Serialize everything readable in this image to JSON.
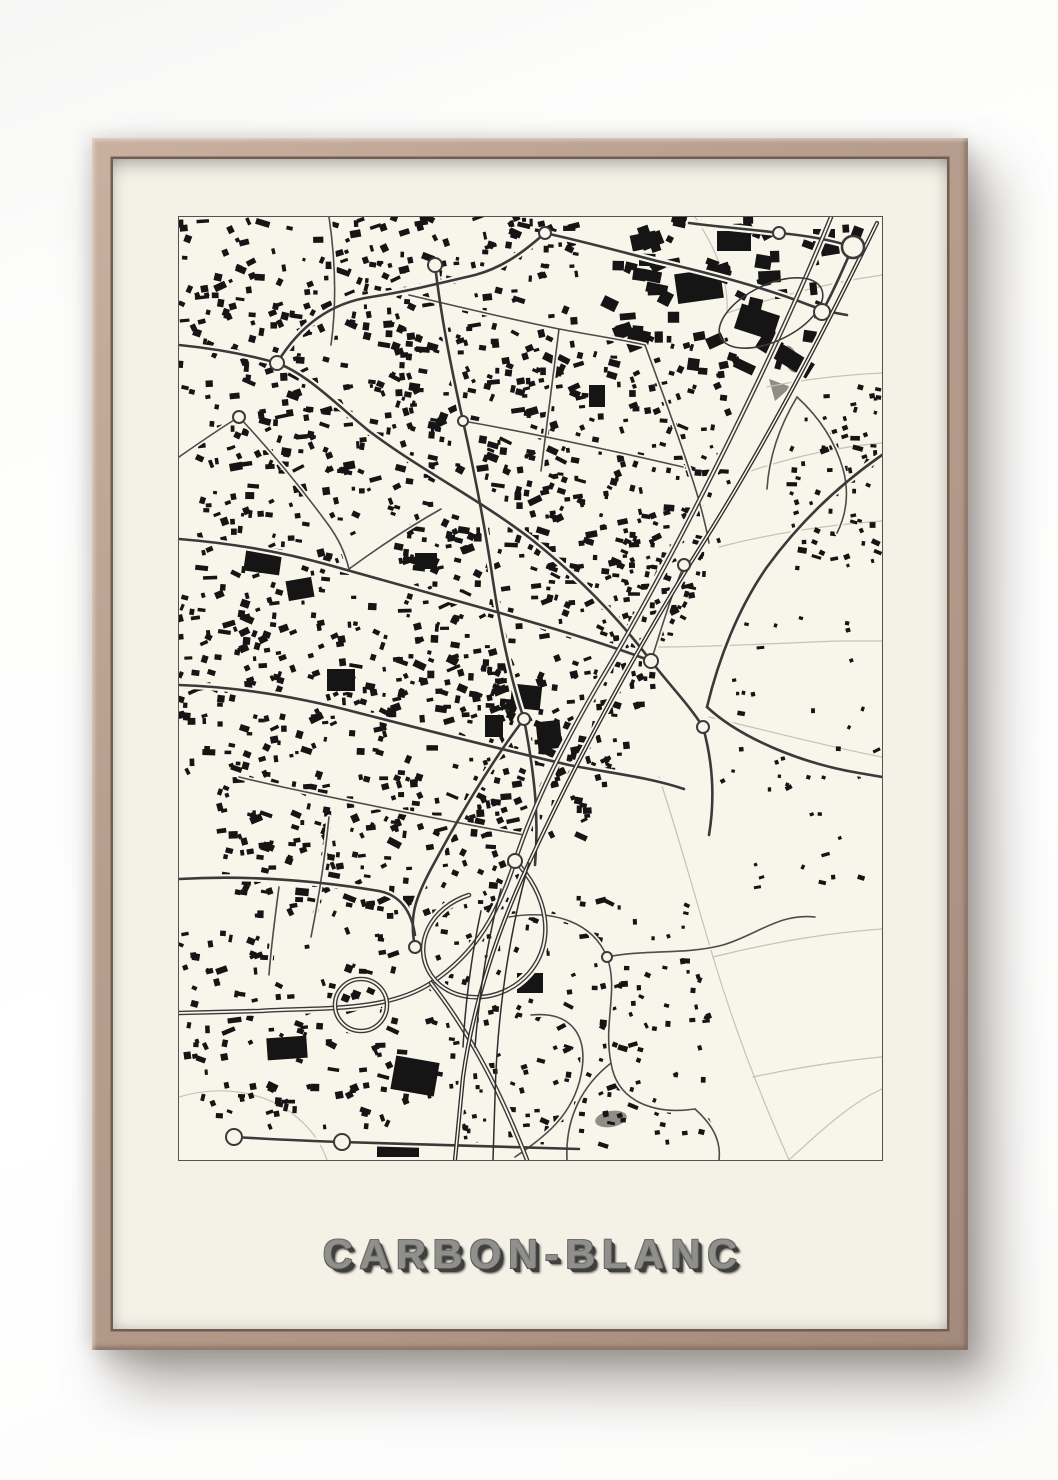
{
  "poster": {
    "title": "CARBON-BLANC"
  },
  "map": {
    "viewbox": "0 0 703 943",
    "seed": 7,
    "colors": {
      "paper": "#f8f5ea",
      "ink": "#151515",
      "road": "#3a3a3a",
      "road_minor": "#4c4c4c",
      "field": "#c6c3b5",
      "gray_fill": "#8e8e86"
    },
    "rail_line": [
      700,
      0.45
    ],
    "field_lines": [
      "M516,0 C536,30 550,62 548,96",
      "M548,96 C590,82 634,70 678,62 L703,58",
      "M588,170 C626,162 664,158 703,156",
      "M566,256 C612,240 658,230 703,226",
      "M540,330 C594,316 648,308 703,304",
      "M476,430 C540,430 600,426 660,424 L703,424",
      "M530,500 C590,514 650,530 703,540",
      "M480,560 C500,620 516,680 534,740 C552,800 574,860 600,920 L610,943",
      "M534,740 C590,726 646,716 703,712",
      "M574,860 C630,848 680,842 703,840",
      "M610,943 C650,906 676,884 703,872",
      "M0,880 C40,868 80,874 110,894 C132,910 142,926 148,943"
    ],
    "roads_minor": [
      "M150,0 C156,40 158,84 152,128",
      "M230,78 C280,90 330,102 380,112 C412,118 440,122 466,128",
      "M380,112 C374,160 368,208 362,254",
      "M466,128 C482,172 498,214 512,258 C520,282 526,304 530,326",
      "M284,204 C330,212 378,222 424,232 C452,238 478,244 504,250",
      "M60,200 C90,232 120,268 148,306 C160,322 166,336 170,352",
      "M0,240 C20,226 40,212 60,200",
      "M170,352 C200,330 230,310 262,292",
      "M60,560 C100,570 150,580 200,590 C250,600 300,610 345,618",
      "M150,600 C146,640 140,680 132,720",
      "M330,700 C376,692 414,706 428,740 C440,772 424,806 432,846 C438,884 474,898 516,892",
      "M428,740 C468,732 506,738 544,728 C578,718 600,696 636,700",
      "M352,798 C392,794 410,818 402,858 C394,898 366,920 336,940",
      "M432,846 C404,868 386,900 388,943",
      "M516,892 C536,910 542,926 540,943",
      "M618,180 C640,200 656,224 664,252 C670,274 668,296 658,316",
      "M618,180 C600,210 590,240 588,272",
      "M100,670 C96,700 92,730 90,758",
      "M505,348 C490,384 480,420 472,444"
    ],
    "roads_major": [
      "M0,128 C40,132 70,138 98,146 C130,158 160,190 190,214 C240,252 300,282 352,322 C400,360 440,402 472,444 C494,472 510,488 524,510",
      "M98,146 C120,110 150,86 192,80 C230,74 262,66 296,58 C326,50 348,32 366,16",
      "M366,16 C402,24 440,34 478,44 C530,56 584,70 630,88 C646,94 656,96 668,98",
      "M0,322 C50,326 100,334 150,348 C200,362 250,376 300,390 C350,404 420,424 472,444",
      "M0,468 C60,470 120,480 180,496 C250,514 320,532 390,548 C430,556 470,560 505,572",
      "M256,48 C262,100 272,150 284,204 C296,258 306,310 314,364 C322,418 334,470 345,502 C356,560 360,600 356,648",
      "M345,502 C310,548 280,600 252,652 C236,682 230,700 236,730",
      "M524,510 C534,546 536,582 530,618",
      "M0,662 C70,658 140,664 200,674 C220,678 232,692 236,718",
      "M703,238 C660,268 620,306 588,350 C560,390 540,440 528,490",
      "M528,490 C560,520 620,546 680,556 L703,560",
      "M643,95 C658,68 666,46 674,30",
      "M674,30 C650,22 622,18 600,16 C570,12 540,10 510,6",
      "M55,920 C90,922 128,924 163,925 C240,928 320,930 400,932"
    ],
    "motorway": [
      "M652,0 C618,84 580,164 540,244 C500,324 462,396 420,466 C384,528 356,584 336,644 C320,694 298,736 252,766 C206,796 140,790 80,794 L0,796",
      "M336,644 C368,676 378,724 350,756 C322,788 272,788 252,758 C232,728 252,690 290,678",
      "M252,766 C288,812 320,870 348,943",
      "M156,788 a26,26 0 1 0 52,0 a26,26 0 1 0 -52,0"
    ],
    "railway": [
      "M698,6 C650,104 592,218 524,326 C462,424 400,538 350,646 C318,714 294,788 284,860 L276,943"
    ],
    "rail_spurs": [
      "M350,646 C330,716 318,798 316,880 L314,943",
      "M322,672 C308,724 300,780 296,830",
      "M302,694 C292,740 286,790 284,830"
    ],
    "oval_road": {
      "cx": 592,
      "cy": 96,
      "rx": 56,
      "ry": 28,
      "rot": -26
    },
    "gray_shapes": [
      {
        "type": "ellipse",
        "cx": 432,
        "cy": 902,
        "rx": 16,
        "ry": 8,
        "rot": -10
      },
      {
        "type": "polygon",
        "points": "590,162 612,170 596,184"
      },
      {
        "type": "ellipse",
        "cx": 612,
        "cy": 142,
        "rx": 7,
        "ry": 14,
        "rot": -20
      }
    ],
    "roundabouts": [
      [
        98,
        146,
        7
      ],
      [
        60,
        200,
        6
      ],
      [
        256,
        48,
        7
      ],
      [
        366,
        16,
        6
      ],
      [
        472,
        444,
        7
      ],
      [
        345,
        502,
        6
      ],
      [
        643,
        95,
        8
      ],
      [
        674,
        30,
        11
      ],
      [
        600,
        16,
        6
      ],
      [
        55,
        920,
        8
      ],
      [
        163,
        925,
        8
      ],
      [
        336,
        644,
        7
      ],
      [
        236,
        730,
        6
      ],
      [
        505,
        348,
        6
      ],
      [
        284,
        204,
        5
      ],
      [
        428,
        740,
        5
      ],
      [
        524,
        510,
        6
      ]
    ],
    "large_buildings": [
      [
        497,
        54,
        46,
        30,
        -8
      ],
      [
        558,
        92,
        40,
        26,
        18
      ],
      [
        576,
        130,
        60,
        17,
        32
      ],
      [
        538,
        14,
        34,
        20,
        0
      ],
      [
        634,
        12,
        22,
        14,
        0
      ],
      [
        452,
        16,
        26,
        16,
        -12
      ],
      [
        66,
        330,
        36,
        26,
        8
      ],
      [
        108,
        362,
        26,
        20,
        -10
      ],
      [
        148,
        452,
        28,
        22,
        0
      ],
      [
        332,
        468,
        30,
        24,
        6
      ],
      [
        358,
        504,
        24,
        28,
        -6
      ],
      [
        306,
        498,
        18,
        22,
        0
      ],
      [
        214,
        842,
        44,
        34,
        10
      ],
      [
        88,
        820,
        40,
        22,
        -4
      ],
      [
        198,
        926,
        42,
        14,
        0
      ],
      [
        338,
        756,
        26,
        20,
        0
      ],
      [
        236,
        336,
        22,
        16,
        0
      ],
      [
        410,
        168,
        16,
        22,
        0
      ]
    ],
    "districts": [
      [
        0,
        0,
        400,
        180,
        300,
        3,
        8,
        "w"
      ],
      [
        20,
        180,
        360,
        200,
        280,
        3,
        8,
        "w"
      ],
      [
        0,
        380,
        340,
        180,
        260,
        3,
        8,
        "w"
      ],
      [
        40,
        560,
        300,
        140,
        190,
        3,
        8,
        "w"
      ],
      [
        340,
        120,
        210,
        300,
        250,
        3,
        7,
        "w"
      ],
      [
        300,
        440,
        210,
        180,
        200,
        3,
        8,
        "w"
      ],
      [
        430,
        0,
        250,
        150,
        80,
        6,
        14,
        "w"
      ],
      [
        600,
        170,
        100,
        190,
        70,
        3,
        6,
        "e"
      ],
      [
        250,
        680,
        280,
        250,
        190,
        3,
        6,
        "a"
      ],
      [
        0,
        710,
        230,
        200,
        130,
        3,
        8,
        "w"
      ],
      [
        540,
        400,
        160,
        280,
        40,
        3,
        5,
        "e"
      ],
      [
        420,
        320,
        120,
        130,
        70,
        3,
        6,
        "w"
      ]
    ]
  }
}
